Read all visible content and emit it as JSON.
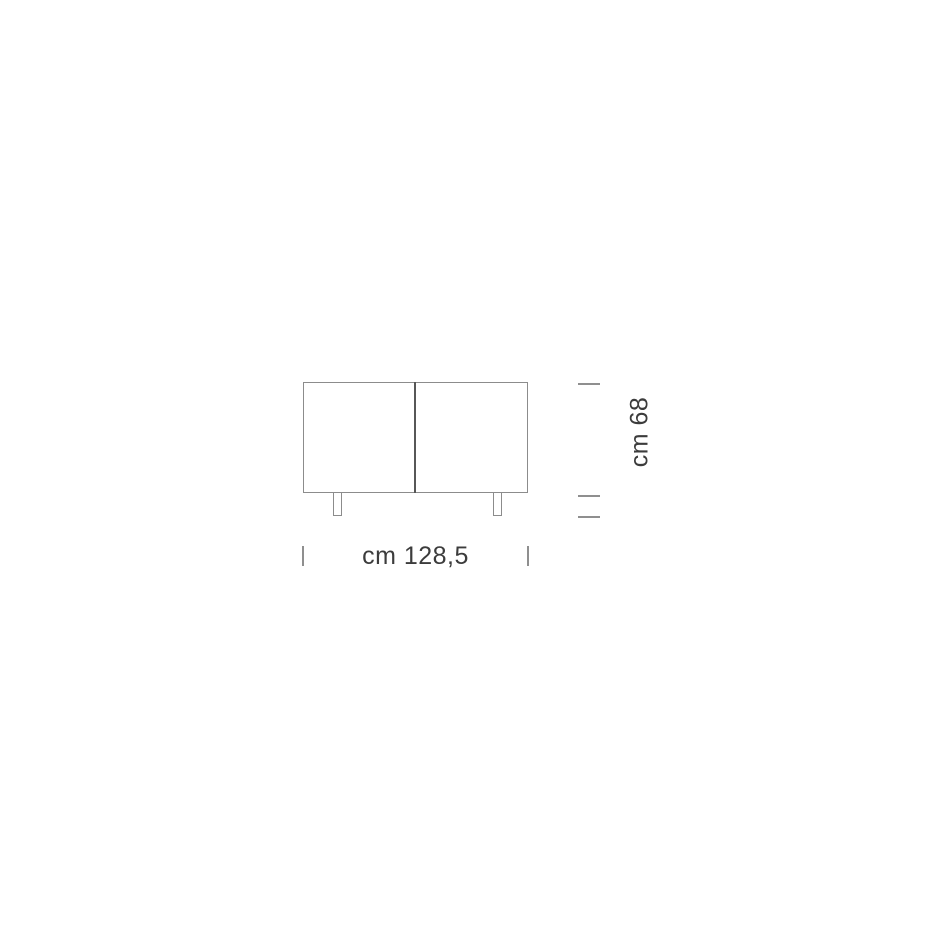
{
  "diagram": {
    "subject": "two-door-sideboard-front-elevation",
    "width_label": "cm 128,5",
    "height_label": "cm 68",
    "width_cm": 128.5,
    "height_cm": 68,
    "colors": {
      "background": "#ffffff",
      "outline": "#8c8c8c",
      "divider": "#575757",
      "tick": "#8f8f8f",
      "text": "#3c3c3c"
    }
  }
}
